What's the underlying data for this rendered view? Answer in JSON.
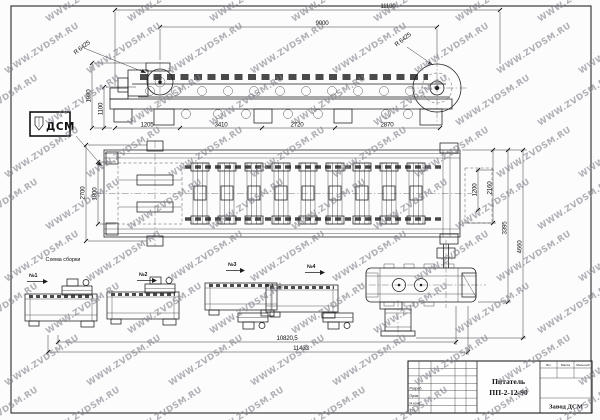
{
  "watermark": {
    "text": "WWW.ZVDSM.RU"
  },
  "logo": {
    "text": "ДСМ"
  },
  "side_view": {
    "dim_total": "11180",
    "dim_span": "9000",
    "radius_left": "R 6425",
    "radius_right": "R 6425",
    "dim_height": "1980",
    "dim_height_inner": "1100",
    "dims_bottom": [
      "1205",
      "3410",
      "2720",
      "2870"
    ]
  },
  "plan_view": {
    "dim_width": "2700",
    "dim_width_inner": "1800",
    "dims_right": [
      "1200",
      "2160",
      "3395",
      "4660"
    ]
  },
  "overall_dims": {
    "upper": "10820,5",
    "lower": "11433"
  },
  "scheme": {
    "title": "Схема сборки",
    "steps": [
      "№1",
      "№2",
      "№3",
      "№4"
    ]
  },
  "title_block": {
    "product": "Питатель",
    "code": "ПП-2-12-90",
    "company": "Завод ДСМ",
    "sig_rows": [
      "Разраб.",
      "Пров.",
      "Н.конт.",
      "Утв."
    ],
    "mini_cols": [
      "Лит.",
      "Масса",
      "Масштаб"
    ]
  }
}
